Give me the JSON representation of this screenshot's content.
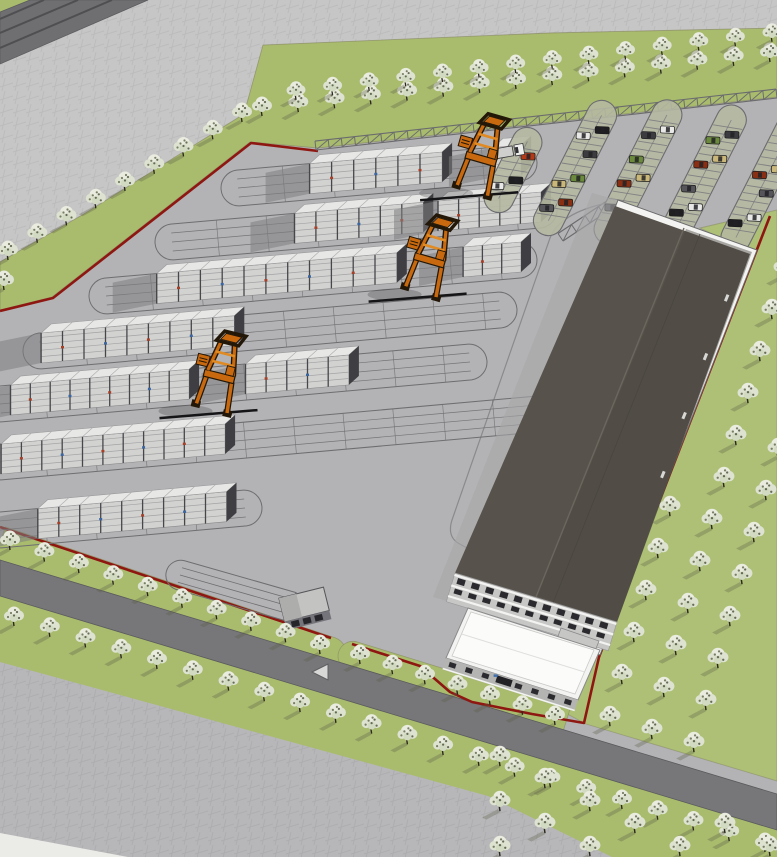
{
  "scene": {
    "description": "Aerial 3D site-plan rendering of a container terminal: seven container stack rows with three orange straddle-carrier cranes, a large dark-roof warehouse, a white office building, a gate house with truck queue lanes, an employee parking lot with cars, perimeter truss fence, tree-lined roads, orchard grid of flowering trees and a red property boundary line",
    "style": "sketchup-render",
    "counts": {
      "cranes": 3,
      "container_rows": 7,
      "parking_islands": 5,
      "buildings": 3,
      "roads": 2
    },
    "labels": {
      "warehouse": "warehouse",
      "office": "office-building",
      "gatehouse": "gate-house",
      "crane": "straddle-carrier-crane",
      "container_row": "container-stack-row",
      "parking_island": "parking-row",
      "boundary": "property-boundary-line",
      "fence": "perimeter-truss-fence",
      "tree": "flowering-tree",
      "truck": "terminal-truck",
      "road_marking": "yield-triangle-marking"
    },
    "palette": {
      "yard": "#b3b3b5",
      "plaza": "#c6c6c6",
      "plazaBottom": "#b7b7b9",
      "roadDark": "#77777a",
      "roadTopLeft": "#6f6f72",
      "roadLine": "#4f4f52",
      "whiteCorner": "#ebebe7",
      "grass": "#a9bc6d",
      "orchardGrass": "#adc075",
      "grassEdge": "#83835f",
      "red": "#8e1712",
      "fence": "#6b6b6e",
      "rack": "#6e6e71",
      "shadow": "#7e7e80",
      "containerFront": "#d2d2d0",
      "containerTop": "#e7e7e5",
      "containerEnd": "#3f3f43",
      "tierLine": "#a3a3a5",
      "seam": "#47474b",
      "speckRed": "#a84028",
      "speckBlue": "#3a66a2",
      "craneOrange": "#c8690f",
      "craneLight": "#e08a24",
      "craneDeep": "#231708",
      "warehouseRoof": "#57524b",
      "warehouseRoofDark": "#4c4841",
      "ridge": "#6b665e",
      "parapet": "#f3f3f1",
      "facade": "#c7c7c5",
      "windowDark": "#2b2b2f",
      "officeRoof": "#fbfbf9",
      "officeFacade": "#b4b4b2",
      "blueSign": "#3f6fae",
      "islandFill": "#b5b8a1",
      "islandLine": "#6c6c70",
      "stall": "#77777c",
      "treeCanopy": "#e9ecdf",
      "treeCanopy2": "#dde3d0",
      "treeCanopy3": "#d2dac2",
      "treeDot": "#565c40",
      "treeDot2": "#3f4430",
      "trunk": "#2c2820",
      "treeShadow": "#5c5c46",
      "marking": "#d8d8d6",
      "truckBody": "#cfcfcd",
      "truckCab": "#ededeb",
      "black": "#1a1a1c"
    },
    "car_colors": [
      "#b43a17",
      "#1f1f21",
      "#e8e8e6",
      "#3c3c40",
      "#6b8a3c",
      "#c9b87a",
      "#8a2f12",
      "#55555a",
      "#e8e8e6",
      "#1f1f21"
    ]
  }
}
